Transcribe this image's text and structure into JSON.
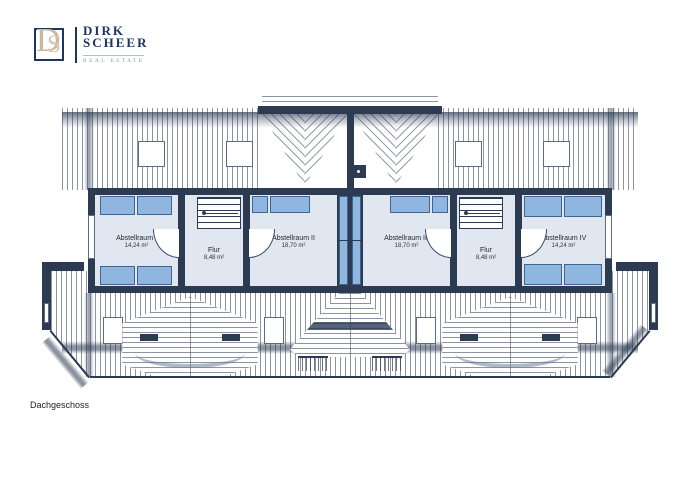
{
  "brand": {
    "monogram_d": "D",
    "monogram_s": "S",
    "name_line1": "DIRK",
    "name_line2": "SCHEER",
    "tagline": "REAL ESTATE"
  },
  "floor_label": "Dachgeschoss",
  "rooms": [
    {
      "name": "Abstellraum I",
      "area": "14,24 m²"
    },
    {
      "name": "Flur",
      "area": "8,48 m²"
    },
    {
      "name": "Abstellraum II",
      "area": "18,70 m²"
    },
    {
      "name": "Abstellraum III",
      "area": "18,70 m²"
    },
    {
      "name": "Flur",
      "area": "8,48 m²"
    },
    {
      "name": "Abstellraum IV",
      "area": "14,24 m²"
    }
  ],
  "colors": {
    "wall_navy": "#2c3b52",
    "room_floor": "#e1e7f0",
    "furniture_blue": "#8fb6de",
    "furniture_border": "#3f648e",
    "logo_navy": "#1e3560",
    "logo_beige": "#c9b7a0",
    "tagline_blue": "#7e9dbd"
  }
}
